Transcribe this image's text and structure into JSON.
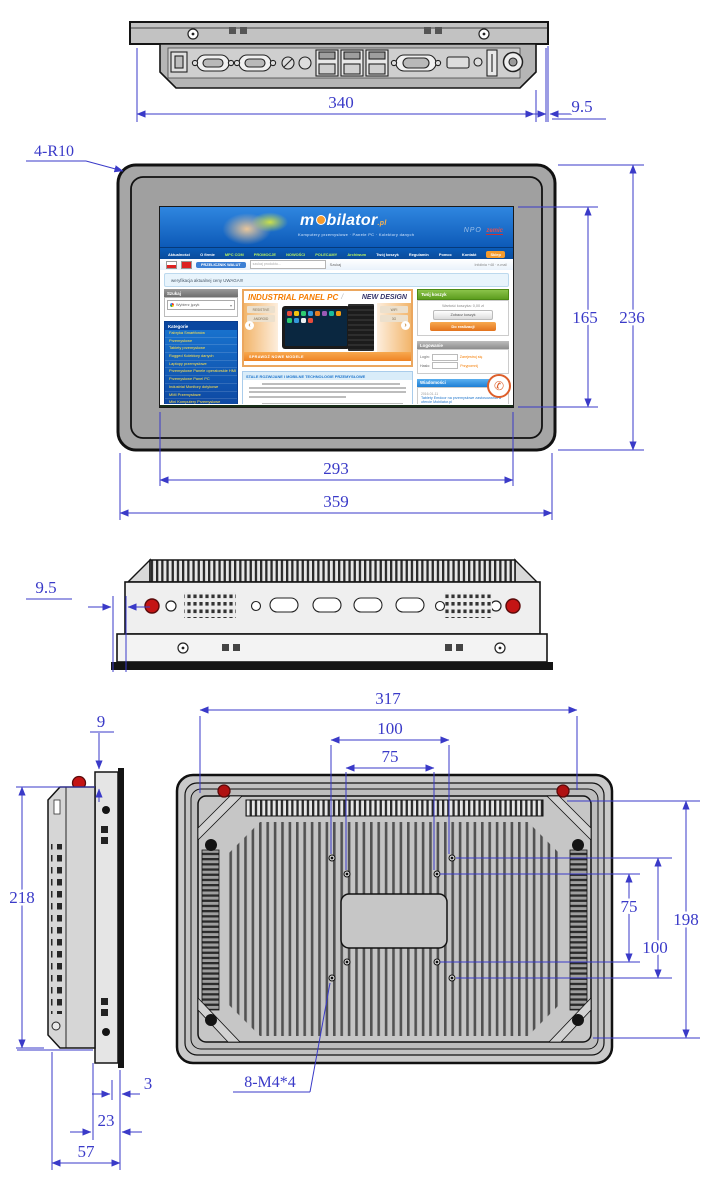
{
  "drawing": {
    "units": "mm",
    "colors": {
      "dimension_blue": "#3a3ac8",
      "line_black": "#141414",
      "bezel_gray": "#a6a6a6",
      "screw_red": "#c41414"
    },
    "dims": {
      "top_width": "340",
      "top_depth": "9.5",
      "front_corner": "4-R10",
      "screen_h": "165",
      "front_h": "236",
      "screen_w": "293",
      "front_w": "359",
      "side_depth": "9.5",
      "profile_top": "9",
      "profile_h": "218",
      "bezel": "3",
      "body_depth": "23",
      "total_depth": "57",
      "back_w": "317",
      "vesa100_h": "100",
      "vesa75_h": "75",
      "vesa75_v": "75",
      "vesa100_v": "100",
      "back_h": "198",
      "mount": "8-M4*4"
    }
  },
  "screen": {
    "logo_prefix": "m",
    "logo_suffix": "bilator",
    "logo_tld": ".pl",
    "tagline": "Komputery przemysłowe · Panele PC · Kolektory danych",
    "brand_right": "NPO",
    "brand_right2": "zemic",
    "nav": [
      {
        "label": "Aktualności",
        "color": "#ffffff"
      },
      {
        "label": "O firmie",
        "color": "#ffffff"
      },
      {
        "label": "MPC COM",
        "color": "#b6f05e"
      },
      {
        "label": "PROMOCJE",
        "color": "#b6f05e"
      },
      {
        "label": "NOWOŚCI",
        "color": "#b6f05e"
      },
      {
        "label": "POLECAMY",
        "color": "#b6f05e"
      },
      {
        "label": "Archiwum",
        "color": "#b6f05e"
      },
      {
        "label": "Twój koszyk",
        "color": "#ffffff"
      },
      {
        "label": "Regulamin",
        "color": "#ffffff"
      },
      {
        "label": "Pomoc",
        "color": "#ffffff"
      },
      {
        "label": "Kontakt",
        "color": "#ffffff"
      },
      {
        "label": "Sklep",
        "color": "#ffffff",
        "bg": "#f59b2d"
      }
    ],
    "currency_btn": "PRZELICZNIK WALUT",
    "search_placeholder": "szukaj produktu...",
    "search_btn": "Szukaj",
    "topbar_right": "Infolinia +48 · e-mail",
    "notice": "weryfikacja aktualnej ceny UWAGA!!!",
    "search_header": "Szukaj",
    "search_select": "Wybierz język",
    "cats_header": "Kategorie",
    "cats": [
      "Fabryka Smartfonów",
      "Przemysłowe",
      "Tablety przemysłowe",
      "Rugged Kolektory danych",
      "Laptopy przemysłowe",
      "Przemysłowe Panele operatorskie HMI",
      "Przemysłowe Panel PC",
      "Industrial Monitory dotykowe",
      "MMI Przemysłowe",
      "Mini Komputery Przemysłowe",
      "MiniPC Przemysłowe",
      "SmartPhony Przemysłowe",
      "Intel Compute Stick"
    ],
    "banner_title": "INDUSTRIAL PANEL PC",
    "banner_divider": "/",
    "banner_sub": "NEW DESIGN",
    "banner_chips_left": [
      "RESISTIVE",
      "ANDROID"
    ],
    "banner_chips_right": [
      "WIFI",
      "3G"
    ],
    "banner_strip": "SPRAWDŹ NOWE MODELE",
    "content_header": "STALE ROZWIJANE I MOBILNE TECHNOLOGIE PRZEMYSŁOWE",
    "cart_header": "Twój koszyk",
    "cart_line": "Wartość koszyka: 0,00 zł",
    "cart_btn1": "Zobacz koszyk",
    "cart_btn2": "Do realizacji",
    "login_header": "Logowanie",
    "login_row1_label": "Login:",
    "login_row1_link": "Zarejestruj się",
    "login_row2_label": "Hasło:",
    "login_row2_link": "Przypomnij",
    "news_header": "Wiadomości",
    "news": [
      {
        "date": "2016-01-11",
        "text": "Tablety Emdoor na przemysłowe zastosowania w ofercie Mobilator.pl"
      },
      {
        "date": "2016-01-04",
        "text": "Nowość! Mini komputery przemysłowe NODKA z chłodzeniem pasywnym"
      }
    ],
    "phone_icon": "✆"
  }
}
